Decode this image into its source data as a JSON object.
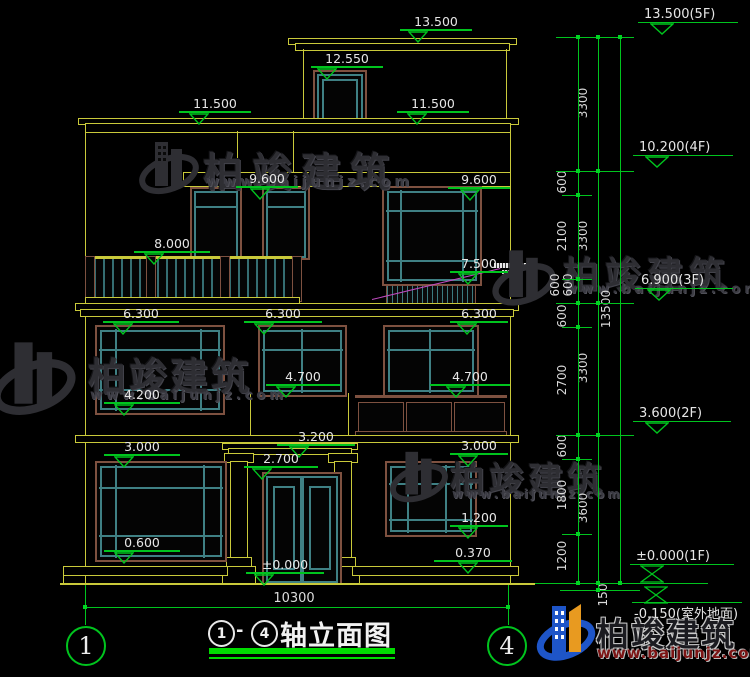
{
  "watermark": {
    "brand": "柏竣建筑",
    "url": "www.baijunjz.com"
  },
  "logo": {
    "brand": "柏竣建筑",
    "url": "www.baijunjz.com"
  },
  "title_block": {
    "axis_from": "1",
    "separator": "-",
    "axis_to": "4",
    "title": "轴立面图"
  },
  "ground_dimension": {
    "value": "10300"
  },
  "axis_bubbles": {
    "left": "1",
    "right": "4"
  },
  "elevation_labels": [
    {
      "t": "13.500",
      "x": 400,
      "y": 14,
      "w": 72,
      "tx": 8
    },
    {
      "t": "12.550",
      "x": 311,
      "y": 51,
      "w": 72,
      "tx": 6
    },
    {
      "t": "11.500",
      "x": 179,
      "y": 96,
      "w": 72,
      "tx": 10
    },
    {
      "t": "11.500",
      "x": 397,
      "y": 96,
      "w": 72,
      "tx": 10
    },
    {
      "t": "9.600",
      "x": 236,
      "y": 171,
      "w": 62,
      "tx": 14
    },
    {
      "t": "9.600",
      "x": 448,
      "y": 172,
      "w": 62,
      "tx": 12
    },
    {
      "t": "8.000",
      "x": 134,
      "y": 236,
      "w": 76,
      "tx": 10
    },
    {
      "t": "7.500",
      "x": 450,
      "y": 256,
      "w": 58,
      "tx": 8
    },
    {
      "t": "6.300",
      "x": 103,
      "y": 306,
      "w": 76,
      "tx": 10
    },
    {
      "t": "6.300",
      "x": 244,
      "y": 306,
      "w": 78,
      "tx": 10
    },
    {
      "t": "6.300",
      "x": 450,
      "y": 306,
      "w": 58,
      "tx": 7
    },
    {
      "t": "4.700",
      "x": 266,
      "y": 369,
      "w": 74,
      "tx": 10
    },
    {
      "t": "4.700",
      "x": 430,
      "y": 369,
      "w": 80,
      "tx": 16
    },
    {
      "t": "4.200",
      "x": 104,
      "y": 387,
      "w": 76,
      "tx": 10
    },
    {
      "t": "3.200",
      "x": 277,
      "y": 429,
      "w": 78,
      "tx": 12
    },
    {
      "t": "3.000",
      "x": 104,
      "y": 439,
      "w": 76,
      "tx": 10
    },
    {
      "t": "3.000",
      "x": 450,
      "y": 438,
      "w": 58,
      "tx": 8
    },
    {
      "t": "2.700",
      "x": 244,
      "y": 451,
      "w": 74,
      "tx": 8
    },
    {
      "t": "1.200",
      "x": 450,
      "y": 510,
      "w": 58,
      "tx": 8
    },
    {
      "t": "0.600",
      "x": 104,
      "y": 535,
      "w": 76,
      "tx": 10
    },
    {
      "t": "0.370",
      "x": 434,
      "y": 545,
      "w": 78,
      "tx": 24
    },
    {
      "t": "±0.000",
      "x": 246,
      "y": 557,
      "w": 78,
      "tx": 8
    }
  ],
  "floor_levels": [
    {
      "t": "13.500(5F)",
      "x": 638,
      "y": 7,
      "w": 100,
      "sym": "tri",
      "sx": 12
    },
    {
      "t": "10.200(4F)",
      "x": 633,
      "y": 140,
      "w": 100,
      "sym": "tri",
      "sx": 12
    },
    {
      "t": "6.900(3F)",
      "x": 635,
      "y": 273,
      "w": 98,
      "sym": "tri",
      "sx": 12
    },
    {
      "t": "3.600(2F)",
      "x": 633,
      "y": 406,
      "w": 98,
      "sym": "tri",
      "sx": 12
    },
    {
      "t": "±0.000(1F)",
      "x": 630,
      "y": 549,
      "w": 104,
      "sym": "bowtie",
      "sx": 10
    },
    {
      "t": "-0.150(室外地面)",
      "x": 632,
      "y": 586,
      "w": 110,
      "sym": "bowtie-above",
      "sx": 12
    }
  ],
  "dim_chains": {
    "inner": [
      {
        "v": "600",
        "y": 183,
        "dx": 0
      },
      {
        "v": "2100",
        "y": 237,
        "dx": 0
      },
      {
        "v": "600",
        "y": 286,
        "dx": -7
      },
      {
        "v": "600",
        "y": 286,
        "dx": 6
      },
      {
        "v": "600",
        "y": 317,
        "dx": 0
      },
      {
        "v": "2700",
        "y": 381,
        "dx": 0
      },
      {
        "v": "600",
        "y": 447,
        "dx": 0
      },
      {
        "v": "1800",
        "y": 496,
        "dx": 0
      },
      {
        "v": "1200",
        "y": 557,
        "dx": 0
      }
    ],
    "middle": [
      {
        "v": "3300",
        "y": 104
      },
      {
        "v": "3300",
        "y": 237
      },
      {
        "v": "3300",
        "y": 369
      },
      {
        "v": "3600",
        "y": 509
      }
    ],
    "outer": [
      {
        "v": "13500",
        "y": 310
      }
    ],
    "base_offset": {
      "v": "150",
      "x": 601,
      "y": 596
    }
  }
}
